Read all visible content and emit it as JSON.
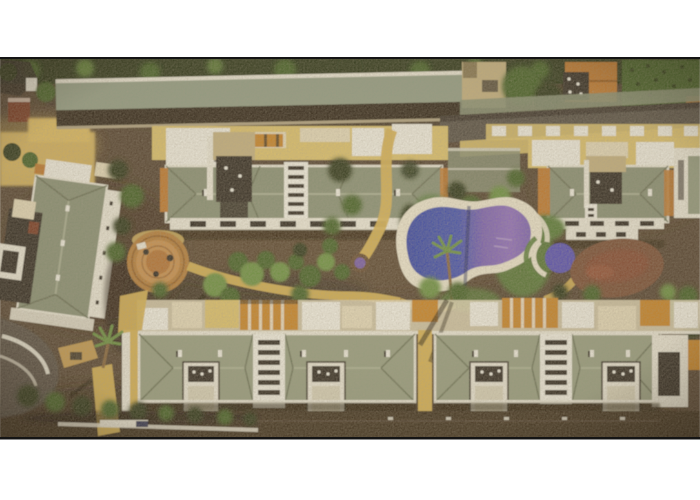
{
  "meta": {
    "domain": "Natural-Image",
    "description": "Aerial satellite photograph of a holiday apartment complex: two long rows of sage-green hip-roofed apartment buildings with white rooftop terraces, a central landscaped garden with palm trees, a circular paved plaza, a blue-violet kidney-shaped swimming pool with a small round children's pool, a brown dirt mound, sandy footpaths, a tilted villa on the left, a long carport building and neighbouring houses along the top, all framed by white margins above and below.",
    "visible_text": []
  },
  "palette": {
    "page_bg": "#ffffff",
    "edge": "#151515",
    "ground": "#5a4937",
    "ground_dark": "#453728",
    "ground_deep": "#3a2e22",
    "road": "#5b554c",
    "veg_dark": "#343e22",
    "veg": "#4c652f",
    "veg_light": "#6f9246",
    "grass": "#5d7d3e",
    "sand": "#ddbc66",
    "path": "#d6b35a",
    "terrace": "#dcc271",
    "white_wall": "#efece0",
    "eave": "#e9e5d6",
    "cream": "#e4d9ba",
    "roof": "#8b9278",
    "roof2": "#9aa084",
    "ridge": "#b2b69b",
    "roof_shadow": "#6b7057",
    "roof_long": "#96a089",
    "roof_long_dark": "#372f24",
    "orange": "#bf7c35",
    "pergola": "#c8872e",
    "stone": "#c5b283",
    "darkbox": "#38322a",
    "redbrown": "#7c402c",
    "plaza": "#b5803f",
    "plaza2": "#c89252",
    "deck": "#e9e2cc",
    "pool1": "#3f4da4",
    "pool2": "#4b57ad",
    "pool3": "#7e65b2",
    "pool4": "#9171bc",
    "kidpool": "#5d55b2",
    "fount": "#7a5ea4",
    "fountring": "#6b5138",
    "dirt": "#7c523b",
    "dirt2": "#8a4f38",
    "navy": "#23284a",
    "trunk": "#8a6a42"
  },
  "scene": {
    "regions": [
      {
        "id": "top-tree-line",
        "label": "dark tree line along top edge of photo"
      },
      {
        "id": "carport-long-building",
        "label": "long narrow building with pale green roof and dark brown lower band"
      },
      {
        "id": "neighboring-houses",
        "label": "stone house, orange tiled roofs, crop garden and perimeter road at top right"
      },
      {
        "id": "upper-apartment-block-left",
        "label": "upper-left apartment block with hip roof, dark roof courtyard and white terraces"
      },
      {
        "id": "upper-apartment-block-right",
        "label": "upper-right apartment block with hip roof and white terraces"
      },
      {
        "id": "left-villa",
        "label": "tilted villa with green hip roof and dark courtyard on the left"
      },
      {
        "id": "central-garden",
        "label": "garden beds, palms, circular orange plaza, small purple fountain, sandy footpaths"
      },
      {
        "id": "pool-area",
        "label": "kidney-shaped blue-violet swimming pool with white deck, round children's pool, brown dirt mound, lawns"
      },
      {
        "id": "lower-roof-terraces",
        "label": "row of cream, white and orange rooftop terrace structures"
      },
      {
        "id": "lower-apartment-block-left",
        "label": "lower-left apartment block with striped stair tower and white balconies"
      },
      {
        "id": "lower-apartment-block-right",
        "label": "lower-right apartment block with striped stair tower and white balconies"
      },
      {
        "id": "left-access-road",
        "label": "curved access road with white retaining walls, hedge row and palm"
      },
      {
        "id": "bottom-service-road",
        "label": "dark service road along the bottom of the complex"
      }
    ]
  }
}
